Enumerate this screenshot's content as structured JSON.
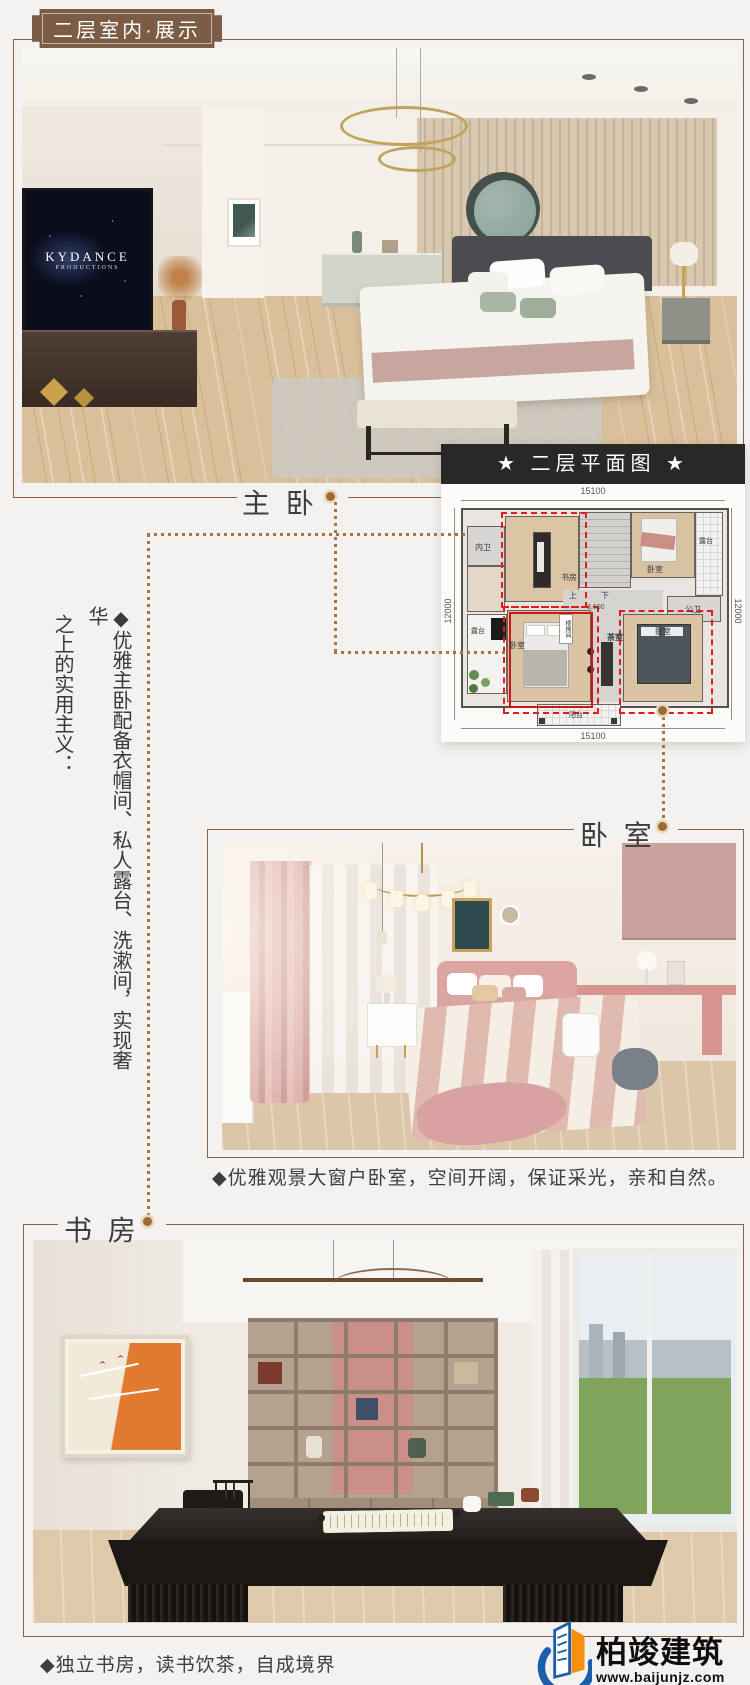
{
  "badge": {
    "title": "二层室内·展示"
  },
  "labels": {
    "master": "主 卧",
    "bedroom": "卧 室",
    "study": "书 房"
  },
  "master_photo": {
    "tv_line1": "KYDANCE",
    "tv_line2": "PRODUCTIONS"
  },
  "plan": {
    "title": "★ 二层平面图 ★",
    "dims": {
      "top": "15100",
      "bottom": "15100",
      "left": "12000",
      "right": "12000",
      "stair_width": "3,600"
    },
    "rooms": {
      "bath_inner": "内卫",
      "study": "书房",
      "bed_top": "卧室",
      "terrace_right": "露台",
      "bath_public": "公卫",
      "stair_up": "上",
      "stair_down": "下",
      "stairwell": "楼梯间",
      "tea": "茶室",
      "terrace_left": "露台",
      "bed_master": "卧室",
      "bed_right": "卧室",
      "balcony": "阳台"
    }
  },
  "note": {
    "line1": "◆优雅主卧配备衣帽间、私人露台、洗漱间，实现奢华",
    "line2": "之上的实用主义："
  },
  "captions": {
    "bedroom": "◆优雅观景大窗户卧室，空间开阔，保证采光，亲和自然。",
    "study": "◆独立书房，读书饮茶，自成境界"
  },
  "logo": {
    "name": "柏竣建筑",
    "site": "www.baijunjz.com"
  },
  "colors": {
    "accent": "#8a6147",
    "dotted": "#a9743f",
    "badge_bg": "#7c5c45",
    "plan_header_bg": "#2a2826",
    "highlight_red": "#e21b1b",
    "logo_blue": "#1b5fab",
    "logo_orange": "#f5900f"
  }
}
